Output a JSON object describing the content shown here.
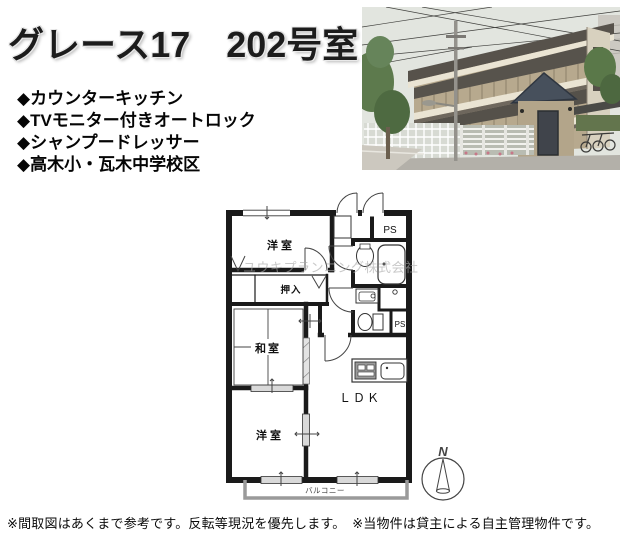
{
  "header": {
    "title": "グレース17　202号室"
  },
  "features": {
    "items": [
      "◆カウンターキッチン",
      "◆TVモニター付きオートロック",
      "◆シャンプードレッサー",
      "◆高木小・瓦木中学校区"
    ]
  },
  "photo": {
    "description": "建物外観写真"
  },
  "floorplan": {
    "room_labels": {
      "bedroom_top": "洋室",
      "ps_top": "PS",
      "closet": "押入",
      "japanese_room": "和室",
      "ldk": "ＬＤＫ",
      "bedroom_bottom": "洋室",
      "ps_side": "PS",
      "balcony": "バルコニー"
    },
    "compass": "N",
    "watermark": "ユウキプランニング株式会社"
  },
  "footer": {
    "note": "※間取図はあくまで参考です。反転等現況を優先します。　※当物件は貸主による自主管理物件です。"
  },
  "colors": {
    "wall": "#1a1a1a",
    "balcony_outline": "#9a9a9a",
    "watermark_gray": "#a8a8a8",
    "building_tan": "#b7a98e"
  }
}
